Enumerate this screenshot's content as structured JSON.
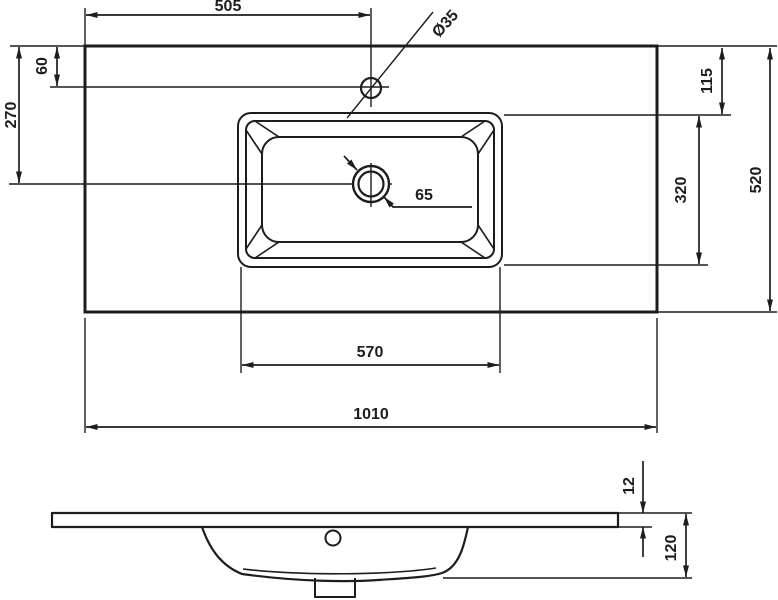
{
  "drawing": {
    "kind": "washbasin dimension drawing",
    "line_color": "#1d1d1d",
    "background": "#ffffff"
  },
  "dims": {
    "faucet_from_left": "505",
    "faucet_hole_diameter": "Ø35",
    "faucet_from_back_edge": "60",
    "drain_from_back_edge": "270",
    "basin_from_back_edge": "115",
    "basin_front_to_back": "320",
    "countertop_depth": "520",
    "basin_cutout_width": "570",
    "countertop_width": "1010",
    "drain_hole_diameter": "65",
    "slab_edge_thickness": "12",
    "total_height": "120"
  }
}
